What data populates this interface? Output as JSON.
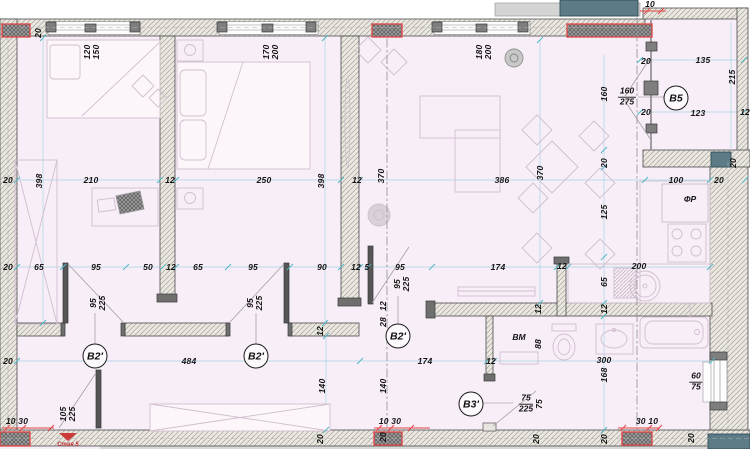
{
  "title": "apartment floor plan sheet",
  "colors": {
    "floor": "#f8eef8",
    "wall_hatch_bg": "#eae7e1",
    "wall_hatch_line": "#a8a49a",
    "dark_block": "#7e7e7e",
    "teal_block": "#5c7b86",
    "accent_red": "#e04545",
    "dim_line": "#4db6c4",
    "text": "#141414"
  },
  "room_markers": [
    {
      "label": "B2'",
      "x": 95,
      "y": 356
    },
    {
      "label": "B2'",
      "x": 256,
      "y": 356
    },
    {
      "label": "B2'",
      "x": 398,
      "y": 336
    },
    {
      "label": "B3'",
      "x": 471,
      "y": 404
    },
    {
      "label": "B5",
      "x": 676,
      "y": 98
    }
  ],
  "annotations": [
    {
      "text": "ФР",
      "x": 690,
      "y": 199,
      "kind": "room-note"
    },
    {
      "text": "ВМ",
      "x": 519,
      "y": 337,
      "kind": "room-note"
    },
    {
      "text": "Стая 5",
      "x": 68,
      "y": 445,
      "kind": "section"
    }
  ],
  "fractions": [
    {
      "top": "160",
      "bottom": "275",
      "x": 627,
      "y": 97
    },
    {
      "top": "75",
      "bottom": "225",
      "x": 526,
      "y": 404
    },
    {
      "top": "60",
      "bottom": "75",
      "x": 696,
      "y": 382
    }
  ],
  "dimensions": [
    {
      "text": "20",
      "x": 38,
      "y": 33,
      "rot": -90
    },
    {
      "text": "120",
      "x": 87,
      "y": 52,
      "rot": -90
    },
    {
      "text": "150",
      "x": 96,
      "y": 52,
      "rot": -90
    },
    {
      "text": "170",
      "x": 266,
      "y": 52,
      "rot": -90
    },
    {
      "text": "200",
      "x": 275,
      "y": 52,
      "rot": -90
    },
    {
      "text": "180",
      "x": 479,
      "y": 52,
      "rot": -90
    },
    {
      "text": "200",
      "x": 488,
      "y": 52,
      "rot": -90
    },
    {
      "text": "10",
      "x": 650,
      "y": 4,
      "rot": 0
    },
    {
      "text": "20",
      "x": 646,
      "y": 61,
      "rot": 0
    },
    {
      "text": "135",
      "x": 703,
      "y": 60,
      "rot": 0
    },
    {
      "text": "215",
      "x": 732,
      "y": 77,
      "rot": -90
    },
    {
      "text": "160",
      "x": 604,
      "y": 94,
      "rot": -90
    },
    {
      "text": "20",
      "x": 646,
      "y": 112,
      "rot": 0
    },
    {
      "text": "123",
      "x": 698,
      "y": 113,
      "rot": 0
    },
    {
      "text": "12",
      "x": 745,
      "y": 112,
      "rot": 0
    },
    {
      "text": "20",
      "x": 604,
      "y": 163,
      "rot": -90
    },
    {
      "text": "20",
      "x": 733,
      "y": 163,
      "rot": -90
    },
    {
      "text": "20",
      "x": 8,
      "y": 180,
      "rot": 0
    },
    {
      "text": "398",
      "x": 39,
      "y": 181,
      "rot": -90
    },
    {
      "text": "210",
      "x": 91,
      "y": 180,
      "rot": 0
    },
    {
      "text": "12",
      "x": 170,
      "y": 180,
      "rot": 0
    },
    {
      "text": "250",
      "x": 264,
      "y": 180,
      "rot": 0
    },
    {
      "text": "398",
      "x": 321,
      "y": 181,
      "rot": -90
    },
    {
      "text": "12",
      "x": 357,
      "y": 180,
      "rot": 0
    },
    {
      "text": "370",
      "x": 381,
      "y": 176,
      "rot": -90
    },
    {
      "text": "386",
      "x": 502,
      "y": 180,
      "rot": 0
    },
    {
      "text": "370",
      "x": 540,
      "y": 173,
      "rot": -90
    },
    {
      "text": "100",
      "x": 676,
      "y": 180,
      "rot": 0
    },
    {
      "text": "20",
      "x": 719,
      "y": 180,
      "rot": 0
    },
    {
      "text": "125",
      "x": 604,
      "y": 212,
      "rot": -90
    },
    {
      "text": "200",
      "x": 639,
      "y": 266,
      "rot": 0
    },
    {
      "text": "20",
      "x": 8,
      "y": 267,
      "rot": 0
    },
    {
      "text": "65",
      "x": 39,
      "y": 267,
      "rot": 0
    },
    {
      "text": "95",
      "x": 96,
      "y": 267,
      "rot": 0
    },
    {
      "text": "50",
      "x": 148,
      "y": 267,
      "rot": 0
    },
    {
      "text": "12",
      "x": 171,
      "y": 267,
      "rot": 0
    },
    {
      "text": "65",
      "x": 198,
      "y": 267,
      "rot": 0
    },
    {
      "text": "95",
      "x": 253,
      "y": 267,
      "rot": 0
    },
    {
      "text": "90",
      "x": 322,
      "y": 267,
      "rot": 0
    },
    {
      "text": "12",
      "x": 356,
      "y": 267,
      "rot": 0
    },
    {
      "text": "5",
      "x": 367,
      "y": 267,
      "rot": 0
    },
    {
      "text": "95",
      "x": 400,
      "y": 267,
      "rot": 0
    },
    {
      "text": "174",
      "x": 498,
      "y": 267,
      "rot": 0
    },
    {
      "text": "12",
      "x": 562,
      "y": 266,
      "rot": 0
    },
    {
      "text": "95",
      "x": 93,
      "y": 303,
      "rot": -90
    },
    {
      "text": "225",
      "x": 102,
      "y": 303,
      "rot": -90
    },
    {
      "text": "95",
      "x": 250,
      "y": 303,
      "rot": -90
    },
    {
      "text": "225",
      "x": 259,
      "y": 303,
      "rot": -90
    },
    {
      "text": "95",
      "x": 397,
      "y": 284,
      "rot": -90
    },
    {
      "text": "225",
      "x": 406,
      "y": 284,
      "rot": -90
    },
    {
      "text": "12",
      "x": 320,
      "y": 331,
      "rot": -90
    },
    {
      "text": "12",
      "x": 383,
      "y": 306,
      "rot": -90
    },
    {
      "text": "28",
      "x": 383,
      "y": 322,
      "rot": -90
    },
    {
      "text": "65",
      "x": 604,
      "y": 282,
      "rot": -90
    },
    {
      "text": "12",
      "x": 538,
      "y": 309,
      "rot": -90
    },
    {
      "text": "12",
      "x": 604,
      "y": 309,
      "rot": -90
    },
    {
      "text": "88",
      "x": 538,
      "y": 344,
      "rot": -90
    },
    {
      "text": "20",
      "x": 8,
      "y": 361,
      "rot": 0
    },
    {
      "text": "484",
      "x": 189,
      "y": 361,
      "rot": 0
    },
    {
      "text": "174",
      "x": 425,
      "y": 361,
      "rot": 0
    },
    {
      "text": "12",
      "x": 491,
      "y": 361,
      "rot": 0
    },
    {
      "text": "300",
      "x": 604,
      "y": 360,
      "rot": 0
    },
    {
      "text": "168",
      "x": 604,
      "y": 375,
      "rot": -90
    },
    {
      "text": "140",
      "x": 322,
      "y": 386,
      "rot": -90
    },
    {
      "text": "140",
      "x": 383,
      "y": 386,
      "rot": -90
    },
    {
      "text": "105",
      "x": 63,
      "y": 414,
      "rot": -90
    },
    {
      "text": "225",
      "x": 72,
      "y": 414,
      "rot": -90
    },
    {
      "text": "75",
      "x": 539,
      "y": 404,
      "rot": -90
    },
    {
      "text": "10 30",
      "x": 17,
      "y": 421,
      "rot": 0
    },
    {
      "text": "10 30",
      "x": 390,
      "y": 421,
      "rot": 0
    },
    {
      "text": "30 10",
      "x": 647,
      "y": 421,
      "rot": 0
    },
    {
      "text": "20",
      "x": 320,
      "y": 439,
      "rot": -90
    },
    {
      "text": "20",
      "x": 383,
      "y": 437,
      "rot": -90
    },
    {
      "text": "20",
      "x": 536,
      "y": 439,
      "rot": -90
    },
    {
      "text": "20",
      "x": 604,
      "y": 439,
      "rot": -90
    },
    {
      "text": "20",
      "x": 691,
      "y": 438,
      "rot": -90
    }
  ]
}
